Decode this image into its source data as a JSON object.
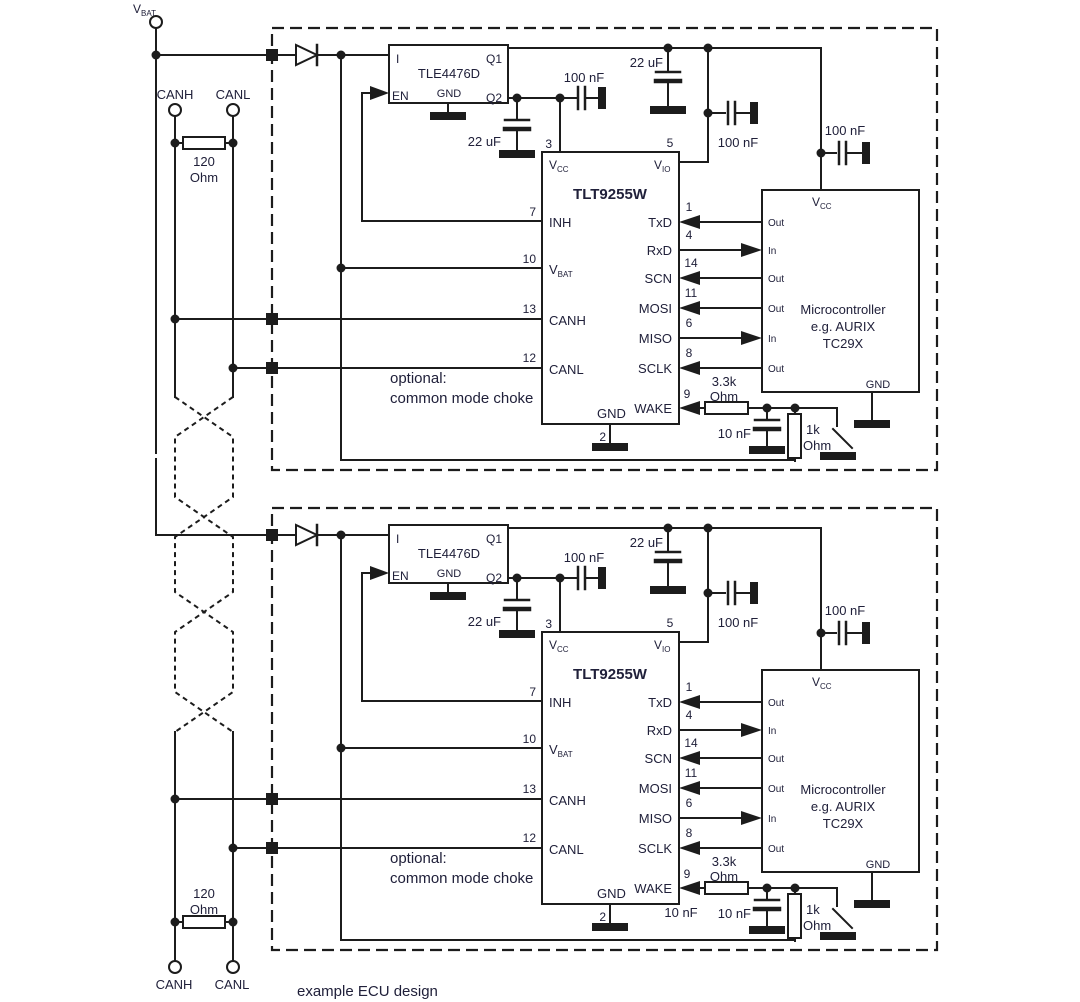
{
  "diagram": {
    "colors": {
      "line": "#1c1c1c",
      "text": "#20203a",
      "background": "#ffffff"
    },
    "caption": "example ECU design",
    "bus": {
      "vbat": {
        "main": "V",
        "sub": "BAT"
      },
      "top": {
        "canh": "CANH",
        "canl": "CANL",
        "resistor_value": "120",
        "resistor_unit": "Ohm"
      },
      "bottom": {
        "canh": "CANH",
        "canl": "CANL",
        "resistor_value": "120",
        "resistor_unit": "Ohm"
      }
    },
    "ecus": [
      {
        "regulator": {
          "name": "TLE4476D",
          "pin_i": "I",
          "pin_en": "EN",
          "pin_gnd": "GND",
          "pin_q1": "Q1",
          "pin_q2": "Q2"
        },
        "transceiver": {
          "name": "TLT9255W",
          "vcc_main": "V",
          "vcc_sub": "CC",
          "num_vcc": "3",
          "vio_main": "V",
          "vio_sub": "IO",
          "num_vio": "5",
          "inh": "INH",
          "num_inh": "7",
          "vbat_main": "V",
          "vbat_sub": "BAT",
          "num_vbat": "10",
          "canh": "CANH",
          "num_canh": "13",
          "canl": "CANL",
          "num_canl": "12",
          "txd": "TxD",
          "num_txd": "1",
          "rxd": "RxD",
          "num_rxd": "4",
          "scn": "SCN",
          "num_scn": "14",
          "mosi": "MOSI",
          "num_mosi": "11",
          "miso": "MISO",
          "num_miso": "6",
          "sclk": "SCLK",
          "num_sclk": "8",
          "wake": "WAKE",
          "num_wake": "9",
          "gnd": "GND",
          "num_gnd": "2"
        },
        "mcu": {
          "line1": "Microcontroller",
          "line2": "e.g. AURIX",
          "line3": "TC29X",
          "vcc_main": "V",
          "vcc_sub": "CC",
          "gnd": "GND",
          "pins": [
            "Out",
            "In",
            "Out",
            "Out",
            "In",
            "Out"
          ]
        },
        "caps": {
          "c22_reg": "22 uF",
          "c100_vcc": "100 nF",
          "c22_vio": "22 uF",
          "c100_vio": "100 nF",
          "c100_mcu": "100 nF",
          "c10_wake": "10 nF"
        },
        "resistors": {
          "wake_series_value": "3.3k",
          "wake_series_unit": "Ohm",
          "wake_pull_value": "1k",
          "wake_pull_unit": "Ohm"
        },
        "note_line1": "optional:",
        "note_line2": "common mode choke"
      },
      {
        "regulator": {
          "name": "TLE4476D",
          "pin_i": "I",
          "pin_en": "EN",
          "pin_gnd": "GND",
          "pin_q1": "Q1",
          "pin_q2": "Q2"
        },
        "transceiver": {
          "name": "TLT9255W",
          "vcc_main": "V",
          "vcc_sub": "CC",
          "num_vcc": "3",
          "vio_main": "V",
          "vio_sub": "IO",
          "num_vio": "5",
          "inh": "INH",
          "num_inh": "7",
          "vbat_main": "V",
          "vbat_sub": "BAT",
          "num_vbat": "10",
          "canh": "CANH",
          "num_canh": "13",
          "canl": "CANL",
          "num_canl": "12",
          "txd": "TxD",
          "num_txd": "1",
          "rxd": "RxD",
          "num_rxd": "4",
          "scn": "SCN",
          "num_scn": "14",
          "mosi": "MOSI",
          "num_mosi": "11",
          "miso": "MISO",
          "num_miso": "6",
          "sclk": "SCLK",
          "num_sclk": "8",
          "wake": "WAKE",
          "num_wake": "9",
          "gnd": "GND",
          "num_gnd": "2"
        },
        "mcu": {
          "line1": "Microcontroller",
          "line2": "e.g. AURIX",
          "line3": "TC29X",
          "vcc_main": "V",
          "vcc_sub": "CC",
          "gnd": "GND",
          "pins": [
            "Out",
            "In",
            "Out",
            "Out",
            "In",
            "Out"
          ]
        },
        "caps": {
          "c22_reg": "22 uF",
          "c100_vcc": "100 nF",
          "c22_vio": "22 uF",
          "c100_vio": "100 nF",
          "c100_mcu": "100 nF",
          "c10_wake": "10 nF",
          "c10_wake_dup": "10 nF"
        },
        "resistors": {
          "wake_series_value": "3.3k",
          "wake_series_unit": "Ohm",
          "wake_pull_value": "1k",
          "wake_pull_unit": "Ohm"
        },
        "note_line1": "optional:",
        "note_line2": "common mode choke"
      }
    ]
  }
}
